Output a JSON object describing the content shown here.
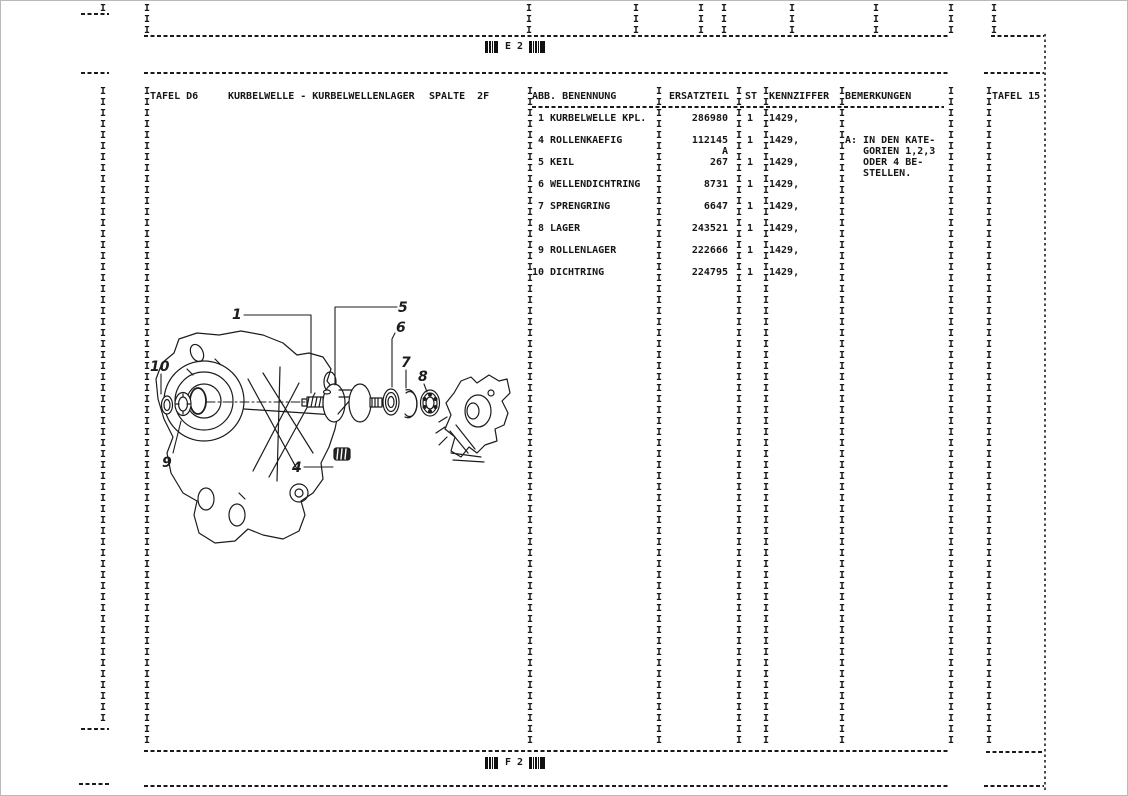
{
  "page": {
    "ink": "#161616",
    "paper": "#ffffff"
  },
  "header_strip": {
    "barcode_label": "E 2"
  },
  "footer_strip": {
    "barcode_label": "F 2"
  },
  "plate": {
    "tafel": "TAFEL D6",
    "title": "KURBELWELLE - KURBELWELLENLAGER",
    "spalte": "SPALTE  2F",
    "next_tafel": "TAFEL 15"
  },
  "table": {
    "headers": {
      "abb_benennung": "ABB. BENENNUNG",
      "ersatzteil": "ERSATZTEIL",
      "st": "ST",
      "kennziffer": "KENNZIFFER",
      "bemerkungen": "BEMERKUNGEN"
    },
    "lines": [
      {
        "abb": "1",
        "name": "KURBELWELLE KPL.",
        "part": "286980",
        "st": "1",
        "kz": "1429,",
        "rem": ""
      },
      {
        "abb": "",
        "name": "",
        "part": "",
        "st": "",
        "kz": "",
        "rem": ""
      },
      {
        "abb": "4",
        "name": "ROLLENKAEFIG",
        "part": "112145",
        "st": "1",
        "kz": "1429,",
        "rem": "A: IN DEN KATE-"
      },
      {
        "abb": "",
        "name": "",
        "part": "A",
        "st": "",
        "kz": "",
        "rem": "   GORIEN 1,2,3"
      },
      {
        "abb": "5",
        "name": "KEIL",
        "part": "267",
        "st": "1",
        "kz": "1429,",
        "rem": "   ODER 4 BE-"
      },
      {
        "abb": "",
        "name": "",
        "part": "",
        "st": "",
        "kz": "",
        "rem": "   STELLEN."
      },
      {
        "abb": "6",
        "name": "WELLENDICHTRING",
        "part": "8731",
        "st": "1",
        "kz": "1429,",
        "rem": ""
      },
      {
        "abb": "",
        "name": "",
        "part": "",
        "st": "",
        "kz": "",
        "rem": ""
      },
      {
        "abb": "7",
        "name": "SPRENGRING",
        "part": "6647",
        "st": "1",
        "kz": "1429,",
        "rem": ""
      },
      {
        "abb": "",
        "name": "",
        "part": "",
        "st": "",
        "kz": "",
        "rem": ""
      },
      {
        "abb": "8",
        "name": "LAGER",
        "part": "243521",
        "st": "1",
        "kz": "1429,",
        "rem": ""
      },
      {
        "abb": "",
        "name": "",
        "part": "",
        "st": "",
        "kz": "",
        "rem": ""
      },
      {
        "abb": "9",
        "name": "ROLLENLAGER",
        "part": "222666",
        "st": "1",
        "kz": "1429,",
        "rem": ""
      },
      {
        "abb": "",
        "name": "",
        "part": "",
        "st": "",
        "kz": "",
        "rem": ""
      },
      {
        "abb": "10",
        "name": "DICHTRING",
        "part": "224795",
        "st": "1",
        "kz": "1429,",
        "rem": ""
      }
    ]
  },
  "diagram": {
    "callouts": [
      "1",
      "4",
      "5",
      "6",
      "7",
      "8",
      "9",
      "10"
    ]
  },
  "form": {
    "rule_char": "I",
    "dash_char": "-"
  }
}
